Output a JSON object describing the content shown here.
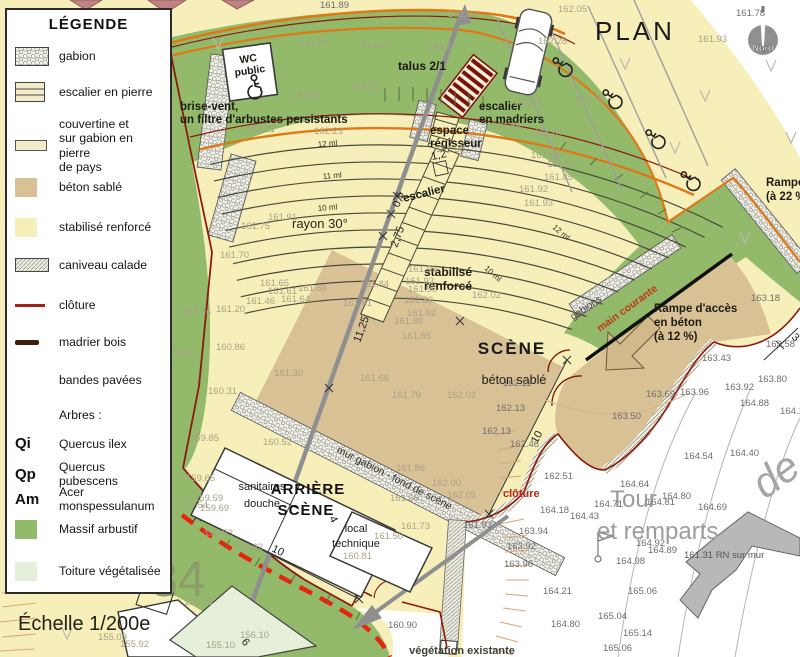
{
  "legend": {
    "title": "LÉGENDE",
    "scale": "Échelle 1/200e",
    "items": {
      "gabion": "gabion",
      "escalier_pierre": "escalier en pierre",
      "couvertine": "couvertine et\nsur gabion en pierre\nde pays",
      "beton": "béton sablé",
      "stabilise": "stabilisé renforcé",
      "caniveau": "caniveau calade",
      "cloture": "clôture",
      "madrier": "madrier bois",
      "bandes": "bandes pavées",
      "arbres_title": "Arbres :",
      "qi_abbr": "Qi",
      "qi_name": "Quercus ilex",
      "qp_abbr": "Qp",
      "qp_name": "Quercus pubescens",
      "am_abbr": "Am",
      "am_name": "Acer monspessulanum",
      "massif": "Massif arbustif",
      "toiture": "Toiture végétalisée"
    }
  },
  "map": {
    "title": "PLAN",
    "north": "Nord",
    "parcel": "84",
    "big_script": "de",
    "labels": {
      "talus": "talus 2/1",
      "brise1": "brise-vent,",
      "brise2": "un filtre d'arbustes persistants",
      "wc1": "WC",
      "wc2": "public",
      "esc_mad1": "escalier",
      "esc_mad2": "en madriers",
      "espace1": "espace",
      "espace2": "régisseur",
      "escalier": "escalier",
      "rayon": "rayon 30°",
      "stab1": "stabilisé",
      "stab2": "renforcé",
      "scene": "SCÈNE",
      "beton_sable": "béton sablé",
      "mur_gabion": "mur gabion - fond de scène",
      "arriere1": "ARRIÈRE",
      "arriere2": "SCÈNE",
      "sanit1": "sanitaires",
      "sanit2": "douche",
      "local1": "local",
      "local2": "technique",
      "gabions": "gabions",
      "main_courante": "main courante",
      "rampe22_1": "Rampe",
      "rampe22_2": "(à 22 %)",
      "rampe12_1": "Rampe d'accès",
      "rampe12_2": "en béton",
      "rampe12_3": "(à 12 %)",
      "cloture": "clôture",
      "tour1": "Tour",
      "tour2": "et remparts",
      "rn": "161.31 RN sur mur",
      "vegetation": "végétation existante"
    },
    "dims": {
      "d05": "0,5",
      "d275": "2,75",
      "d1125": "11,25",
      "d12": "1,2",
      "d10_scene": "10",
      "d10_bottom": "10",
      "d4": "4",
      "d3": "3",
      "d6": "6",
      "ml12": "12 ml",
      "ml11": "11 ml",
      "ml10": "10 ml",
      "ml12b": "12 ml",
      "ml10b": "10 ml"
    },
    "colors": {
      "stabilise": "#f6efb9",
      "beton_sable": "#d9c196",
      "massif": "#93b96b",
      "toiture": "#e6efd9",
      "orange_line": "#e07818",
      "cloture_line": "#8c1a10",
      "cloture_dashed": "#e8240f",
      "axis_gray": "#8f8f8f",
      "madrier": "#7a1408"
    },
    "elevations": [
      [
        320,
        8,
        "161.89",
        "d"
      ],
      [
        448,
        17,
        "162.04",
        "f"
      ],
      [
        558,
        12,
        "162.05",
        "f"
      ],
      [
        736,
        16,
        "161.78",
        "d"
      ],
      [
        698,
        42,
        "161.93",
        "f"
      ],
      [
        300,
        46,
        "162.02",
        "f"
      ],
      [
        362,
        48,
        "161.96",
        "f"
      ],
      [
        428,
        50,
        "162.17",
        "f"
      ],
      [
        538,
        44,
        "162.28",
        "f"
      ],
      [
        350,
        90,
        "162.20",
        "f"
      ],
      [
        292,
        98,
        "162.16",
        "f"
      ],
      [
        314,
        134,
        "162.23",
        "f"
      ],
      [
        246,
        132,
        "162.21",
        "f"
      ],
      [
        513,
        106,
        "161.97",
        "f"
      ],
      [
        576,
        102,
        "161.93",
        "f"
      ],
      [
        492,
        129,
        "161.89",
        "f"
      ],
      [
        534,
        136,
        "161.87",
        "f"
      ],
      [
        436,
        152,
        "161.30",
        "f"
      ],
      [
        531,
        158,
        "161.84",
        "f"
      ],
      [
        547,
        167,
        "161.87",
        "f"
      ],
      [
        544,
        180,
        "161.85",
        "f"
      ],
      [
        519,
        192,
        "161.92",
        "f"
      ],
      [
        524,
        206,
        "161.93",
        "f"
      ],
      [
        268,
        220,
        "161.91",
        "f"
      ],
      [
        241,
        229,
        "161.75",
        "f"
      ],
      [
        220,
        258,
        "161.70",
        "f"
      ],
      [
        260,
        286,
        "161.65",
        "f"
      ],
      [
        268,
        294,
        "161.61",
        "f"
      ],
      [
        298,
        291,
        "161.66",
        "f"
      ],
      [
        246,
        304,
        "161.46",
        "f"
      ],
      [
        281,
        302,
        "161.64",
        "f"
      ],
      [
        216,
        312,
        "161.20",
        "f"
      ],
      [
        182,
        314,
        "159.24",
        "f"
      ],
      [
        165,
        357,
        "158.42",
        "f"
      ],
      [
        216,
        350,
        "160.86",
        "f"
      ],
      [
        208,
        394,
        "160.31",
        "f"
      ],
      [
        274,
        376,
        "161.30",
        "f"
      ],
      [
        360,
        287,
        "161.84",
        "f"
      ],
      [
        408,
        272,
        "161.95",
        "f"
      ],
      [
        405,
        284,
        "161.93",
        "f"
      ],
      [
        408,
        292,
        "161.90",
        "f"
      ],
      [
        404,
        303,
        "161.89",
        "f"
      ],
      [
        343,
        306,
        "161.81",
        "f"
      ],
      [
        472,
        298,
        "162.02",
        "f"
      ],
      [
        407,
        316,
        "161.92",
        "f"
      ],
      [
        394,
        324,
        "161.88",
        "f"
      ],
      [
        402,
        339,
        "161.85",
        "f"
      ],
      [
        360,
        381,
        "161.66",
        "f"
      ],
      [
        392,
        398,
        "161.79",
        "f"
      ],
      [
        447,
        398,
        "162.02",
        "f"
      ],
      [
        263,
        445,
        "160.52",
        "f"
      ],
      [
        396,
        471,
        "161.86",
        "f"
      ],
      [
        432,
        486,
        "162.00",
        "f"
      ],
      [
        390,
        501,
        "161.56",
        "f"
      ],
      [
        447,
        498,
        "162.05",
        "f"
      ],
      [
        190,
        441,
        "159.85",
        "f"
      ],
      [
        186,
        481,
        "159.65",
        "f"
      ],
      [
        194,
        501,
        "159.59",
        "f"
      ],
      [
        179,
        508,
        "159.54",
        "f"
      ],
      [
        200,
        511,
        "159.69",
        "f"
      ],
      [
        204,
        536,
        "159.53",
        "f"
      ],
      [
        234,
        550,
        "159.62",
        "f"
      ],
      [
        401,
        529,
        "161.73",
        "f"
      ],
      [
        374,
        539,
        "161.50",
        "f"
      ],
      [
        343,
        559,
        "160.81",
        "f"
      ],
      [
        388,
        628,
        "160.90",
        "d"
      ],
      [
        463,
        528,
        "161.93",
        "d"
      ],
      [
        33,
        578,
        "153.91",
        "f"
      ],
      [
        98,
        640,
        "155.09",
        "f"
      ],
      [
        120,
        647,
        "155.92",
        "f"
      ],
      [
        184,
        605,
        "156.79",
        "f"
      ],
      [
        240,
        638,
        "156.10",
        "f"
      ],
      [
        206,
        648,
        "155.10",
        "f"
      ],
      [
        503,
        386,
        "162.11",
        "d"
      ],
      [
        496,
        411,
        "162.13",
        "d"
      ],
      [
        482,
        434,
        "162.13",
        "d"
      ],
      [
        510,
        447,
        "162.46",
        "d"
      ],
      [
        544,
        479,
        "162.51",
        "d"
      ],
      [
        612,
        419,
        "163.50",
        "d"
      ],
      [
        646,
        397,
        "163.69",
        "d"
      ],
      [
        680,
        395,
        "163.96",
        "d"
      ],
      [
        725,
        390,
        "163.92",
        "d"
      ],
      [
        758,
        382,
        "163.80",
        "d"
      ],
      [
        740,
        406,
        "164.88",
        "d"
      ],
      [
        780,
        414,
        "164.12",
        "d"
      ],
      [
        684,
        459,
        "164.54",
        "d"
      ],
      [
        730,
        456,
        "164.40",
        "d"
      ],
      [
        620,
        487,
        "164.64",
        "d"
      ],
      [
        646,
        505,
        "164.81",
        "d"
      ],
      [
        662,
        499,
        "164.80",
        "d"
      ],
      [
        698,
        510,
        "164.69",
        "d"
      ],
      [
        540,
        513,
        "164.18",
        "d"
      ],
      [
        594,
        507,
        "164.71",
        "d"
      ],
      [
        570,
        519,
        "164.43",
        "d"
      ],
      [
        519,
        534,
        "163.94",
        "d"
      ],
      [
        507,
        549,
        "163.92",
        "d"
      ],
      [
        504,
        567,
        "163.96",
        "d"
      ],
      [
        636,
        546,
        "164.92",
        "d"
      ],
      [
        648,
        553,
        "164.89",
        "d"
      ],
      [
        616,
        564,
        "164.98",
        "d"
      ],
      [
        543,
        594,
        "164.21",
        "d"
      ],
      [
        628,
        594,
        "165.06",
        "d"
      ],
      [
        598,
        619,
        "165.04",
        "d"
      ],
      [
        551,
        627,
        "164.80",
        "d"
      ],
      [
        623,
        636,
        "165.14",
        "d"
      ],
      [
        603,
        651,
        "165.06",
        "d"
      ],
      [
        751,
        301,
        "163.18",
        "d"
      ],
      [
        702,
        361,
        "163.43",
        "d"
      ],
      [
        766,
        347,
        "163.58",
        "d"
      ]
    ]
  }
}
